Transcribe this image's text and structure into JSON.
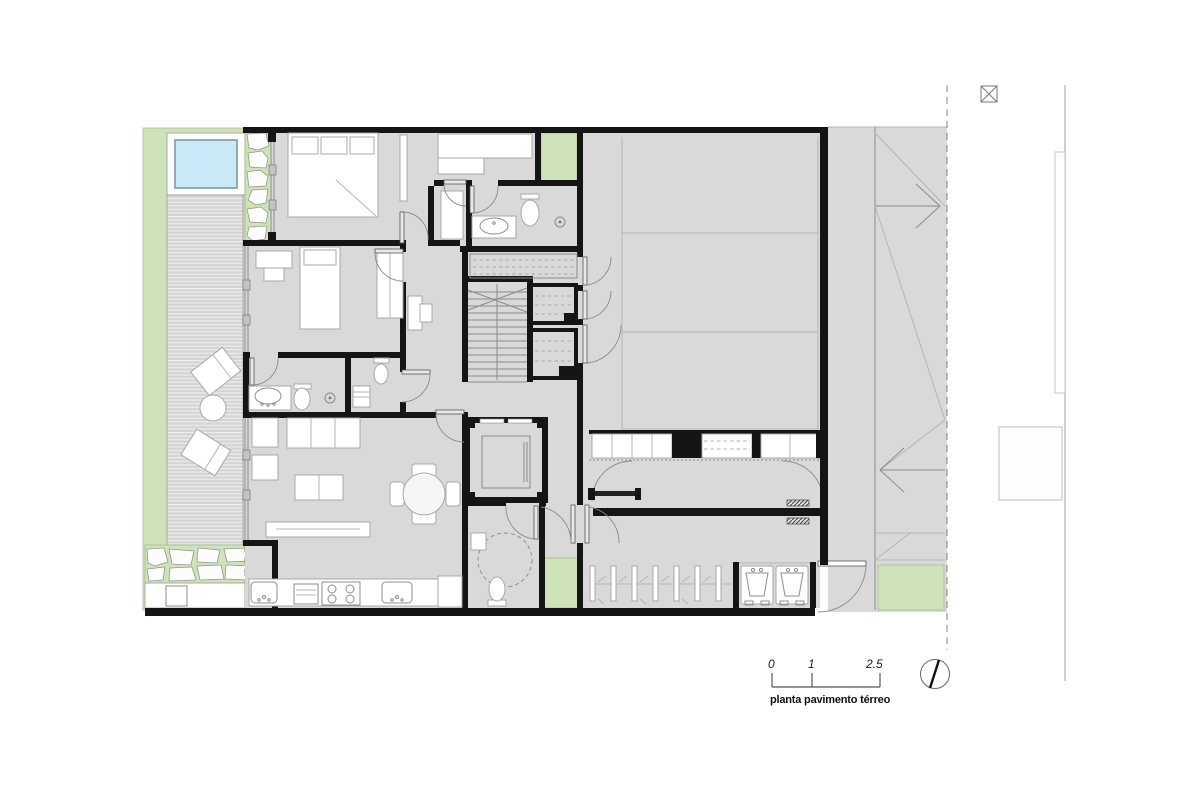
{
  "drawing": {
    "type": "architectural-floor-plan",
    "caption": "planta pavimento térreo",
    "scale_bar": {
      "tick_0": "0",
      "tick_1": "1",
      "tick_2": "2.5"
    },
    "symbols": {
      "north_indicator": "needle-in-circle",
      "boundary_marker": "crossed-box",
      "property_line_style": "dashed",
      "ramp_direction": "arrows"
    },
    "colors": {
      "background": "#ffffff",
      "wall": "#151515",
      "floor": "#d9d9d9",
      "garden_green": "#cfe3ba",
      "pool_water": "#c9e9f7",
      "deck": "#d5d5d5",
      "furniture_outline": "#a8a8a8"
    }
  }
}
